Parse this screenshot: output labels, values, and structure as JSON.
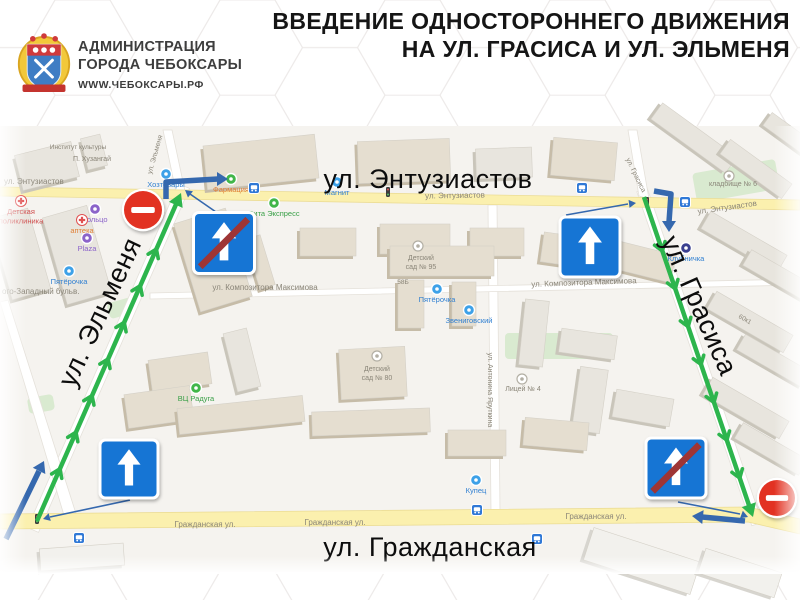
{
  "header": {
    "org_line1": "АДМИНИСТРАЦИЯ",
    "org_line2": "ГОРОДА ЧЕБОКСАРЫ",
    "org_url": "WWW.ЧЕБОКСАРЫ.РФ",
    "title_line1": "ВВЕДЕНИЕ ОДНОСТОРОННЕГО ДВИЖЕНИЯ",
    "title_line2": "НА УЛ. ГРАСИСА И УЛ. ЭЛЬМЕНЯ"
  },
  "colors": {
    "route_green": "#2db54d",
    "arrow_blue": "#3568ae",
    "sign_blue": "#1474d4",
    "sign_stripe_red": "#9e3434",
    "no_entry_red": "#e23223",
    "road_yellow": "#fbf0ae",
    "map_bg": "#f5f3ef"
  },
  "map": {
    "big_labels": [
      {
        "t": "ул. Энтузиастов",
        "x": 428,
        "y": 188,
        "r": 0
      },
      {
        "t": "ул. Эльменя",
        "x": 108,
        "y": 316,
        "r": -65
      },
      {
        "t": "ул. Грасиса",
        "x": 691,
        "y": 309,
        "r": 66
      },
      {
        "t": "ул. Гражданская",
        "x": 430,
        "y": 556,
        "r": 0
      }
    ],
    "small_labels": [
      {
        "t": "ул. Энтузиастов",
        "x": 4,
        "y": 184,
        "a": "start"
      },
      {
        "t": "ул. Энтузиастов",
        "x": 455,
        "y": 198,
        "r": -1
      },
      {
        "t": "ул. Энтузиастов",
        "x": 698,
        "y": 214,
        "r": -8,
        "a": "start"
      },
      {
        "t": "ул. Эльменя",
        "x": 157,
        "y": 155,
        "r": -74,
        "s": 7
      },
      {
        "t": "ул. Грасиса",
        "x": 634,
        "y": 176,
        "r": 64,
        "s": 7
      },
      {
        "t": "Гражданская ул.",
        "x": 205,
        "y": 527
      },
      {
        "t": "Гражданская ул.",
        "x": 335,
        "y": 525
      },
      {
        "t": "Гражданская ул.",
        "x": 596,
        "y": 519
      },
      {
        "t": "ул. Композитора Максимова",
        "x": 265,
        "y": 290
      },
      {
        "t": "ул. Композитора Максимова",
        "x": 584,
        "y": 285,
        "r": -2
      },
      {
        "t": "ого-Западный бульв.",
        "x": 2,
        "y": 294,
        "a": "start"
      },
      {
        "t": "ул. Антонина Яруткина",
        "x": 488,
        "y": 390,
        "r": 90,
        "s": 7
      },
      {
        "t": "П. Хузангай",
        "x": 92,
        "y": 161,
        "s": 7
      },
      {
        "t": "Институт культуры",
        "x": 78,
        "y": 149,
        "s": 6.5
      },
      {
        "t": "кладбище № 6",
        "x": 733,
        "y": 186,
        "s": 7
      },
      {
        "t": "Детский\nсад № 95",
        "x": 421,
        "y": 260,
        "s": 7
      },
      {
        "t": "Детский\nсад № 80",
        "x": 377,
        "y": 371,
        "s": 7
      },
      {
        "t": "Лицей № 4",
        "x": 523,
        "y": 391,
        "s": 7
      },
      {
        "t": "58Б",
        "x": 403,
        "y": 284,
        "s": 6.5
      },
      {
        "t": "60к1",
        "x": 744,
        "y": 321,
        "s": 6.5,
        "r": 30
      }
    ],
    "pois": [
      {
        "x": 166,
        "y": 174,
        "c": "#3da1e8",
        "t": "Хозтовары",
        "lc": "#2f7fd1"
      },
      {
        "x": 231,
        "y": 179,
        "c": "#41b649",
        "t": "Фармация",
        "lc": "#e07f35"
      },
      {
        "x": 337,
        "y": 182,
        "c": "#3da1e8",
        "t": "Магнит",
        "lc": "#2f7fd1"
      },
      {
        "x": 274,
        "y": 203,
        "c": "#41b649",
        "t": "Вита Экспресс",
        "lc": "#3aa048"
      },
      {
        "x": 69,
        "y": 271,
        "c": "#3da1e8",
        "t": "Пятёрочка",
        "lc": "#2f7fd1"
      },
      {
        "x": 95,
        "y": 209,
        "c": "#8b63c9",
        "t": "Кольцо",
        "lc": "#8b63c9"
      },
      {
        "x": 87,
        "y": 238,
        "c": "#8b63c9",
        "t": "Plaza",
        "lc": "#8b63c9"
      },
      {
        "x": 21,
        "y": 201,
        "c": "cross",
        "t": "Детская\nполиклиника",
        "lc": "#d05050"
      },
      {
        "x": 82,
        "y": 220,
        "c": "cross",
        "t": "аптека",
        "lc": "#e07f35"
      },
      {
        "x": 437,
        "y": 289,
        "c": "#3da1e8",
        "t": "Пятёрочка",
        "lc": "#2f7fd1"
      },
      {
        "x": 469,
        "y": 310,
        "c": "#3da1e8",
        "t": "Звениговский",
        "lc": "#2f7fd1"
      },
      {
        "x": 581,
        "y": 235,
        "c": "#3da1e8",
        "t": "Пятёрочка",
        "lc": "#2f7fd1"
      },
      {
        "x": 686,
        "y": 248,
        "c": "#3a3f8f",
        "t": "Клубничка",
        "lc": "#2f7fd1"
      },
      {
        "x": 476,
        "y": 480,
        "c": "#3da1e8",
        "t": "Купец",
        "lc": "#2f7fd1"
      },
      {
        "x": 196,
        "y": 388,
        "c": "#41b649",
        "t": "ВЦ Радуга",
        "lc": "#3aa048"
      },
      {
        "x": 418,
        "y": 246,
        "c": "gray",
        "t": "",
        "lc": ""
      },
      {
        "x": 377,
        "y": 356,
        "c": "gray",
        "t": "",
        "lc": ""
      },
      {
        "x": 522,
        "y": 379,
        "c": "gray",
        "t": "",
        "lc": ""
      },
      {
        "x": 729,
        "y": 176,
        "c": "gray",
        "t": "",
        "lc": ""
      }
    ],
    "bus_stops": [
      {
        "x": 254,
        "y": 188
      },
      {
        "x": 582,
        "y": 188
      },
      {
        "x": 685,
        "y": 202
      },
      {
        "x": 79,
        "y": 538
      },
      {
        "x": 477,
        "y": 510
      },
      {
        "x": 537,
        "y": 539
      }
    ],
    "traffic_lights": [
      {
        "x": 37,
        "y": 519
      },
      {
        "x": 388,
        "y": 192
      },
      {
        "x": 647,
        "y": 202
      }
    ],
    "routes": [
      {
        "name": "elmenya-northbound",
        "a": [
          37,
          521
        ],
        "b": [
          181,
          193
        ]
      },
      {
        "name": "grasisa-southbound",
        "a": [
          644,
          197
        ],
        "b": [
          753,
          517
        ]
      }
    ],
    "thick_arrows": [
      {
        "name": "exit-elmenya-turn-right",
        "pts": [
          [
            166,
            199
          ],
          [
            166,
            182
          ],
          [
            218,
            179
          ]
        ],
        "tip": [
          228,
          179
        ]
      },
      {
        "name": "enter-grasisa-turn-left",
        "pts": [
          [
            654,
            191
          ],
          [
            671,
            194
          ],
          [
            669,
            222
          ]
        ],
        "tip": [
          669,
          232
        ]
      },
      {
        "name": "enter-elmenya-from-grazhdanskaya",
        "pts": [
          [
            6,
            539
          ],
          [
            39,
            471
          ]
        ],
        "tip": [
          44,
          461
        ]
      },
      {
        "name": "exit-grasisa-turn-right",
        "pts": [
          [
            745,
            521
          ],
          [
            702,
            517
          ]
        ],
        "tip": [
          692,
          516
        ]
      }
    ],
    "thin_arrows": [
      {
        "pts": [
          [
            216,
            212
          ],
          [
            190,
            194
          ]
        ],
        "tip": [
          185,
          190
        ]
      },
      {
        "pts": [
          [
            566,
            215
          ],
          [
            628,
            204
          ]
        ],
        "tip": [
          636,
          203
        ]
      },
      {
        "pts": [
          [
            130,
            500
          ],
          [
            50,
            517
          ]
        ],
        "tip": [
          43,
          519
        ]
      },
      {
        "pts": [
          [
            678,
            502
          ],
          [
            740,
            514
          ]
        ],
        "tip": [
          748,
          517
        ]
      }
    ],
    "signs": [
      {
        "k": "no-entry",
        "x": 143,
        "y": 210,
        "r": 19
      },
      {
        "k": "ow-end",
        "x": 224,
        "y": 243,
        "s": 58
      },
      {
        "k": "ow",
        "x": 590,
        "y": 247,
        "s": 57
      },
      {
        "k": "ow",
        "x": 129,
        "y": 469,
        "s": 55
      },
      {
        "k": "ow-end",
        "x": 676,
        "y": 468,
        "s": 57
      },
      {
        "k": "no-entry",
        "x": 777,
        "y": 498,
        "r": 18
      }
    ],
    "green_areas": [
      [
        505,
        333,
        108,
        26,
        0
      ],
      [
        694,
        166,
        84,
        30,
        -10
      ],
      [
        28,
        396,
        26,
        16,
        -10
      ],
      [
        108,
        300,
        26,
        16,
        -16
      ]
    ],
    "buildings": [
      [
        18,
        148,
        58,
        36,
        -14,
        0
      ],
      [
        84,
        136,
        20,
        32,
        -14,
        0
      ],
      [
        205,
        140,
        112,
        44,
        -6,
        1
      ],
      [
        358,
        140,
        92,
        42,
        -2,
        1
      ],
      [
        476,
        148,
        56,
        30,
        -2,
        0
      ],
      [
        552,
        140,
        64,
        38,
        5,
        1
      ],
      [
        648,
        128,
        92,
        20,
        36,
        0
      ],
      [
        718,
        160,
        76,
        18,
        36,
        0
      ],
      [
        762,
        128,
        58,
        16,
        36,
        0
      ],
      [
        0,
        212,
        40,
        84,
        -16,
        0
      ],
      [
        54,
        210,
        46,
        90,
        -16,
        0
      ],
      [
        186,
        214,
        54,
        92,
        -17,
        1
      ],
      [
        252,
        236,
        16,
        52,
        -17,
        1
      ],
      [
        300,
        228,
        56,
        28,
        0,
        1
      ],
      [
        380,
        224,
        70,
        30,
        0,
        1
      ],
      [
        470,
        228,
        54,
        28,
        0,
        1
      ],
      [
        542,
        236,
        60,
        30,
        8,
        1
      ],
      [
        616,
        248,
        58,
        28,
        14,
        1
      ],
      [
        700,
        232,
        88,
        20,
        30,
        0
      ],
      [
        742,
        268,
        78,
        18,
        30,
        0
      ],
      [
        706,
        312,
        88,
        20,
        30,
        0
      ],
      [
        736,
        352,
        76,
        18,
        30,
        0
      ],
      [
        702,
        398,
        88,
        20,
        30,
        0
      ],
      [
        734,
        440,
        74,
        18,
        30,
        0
      ],
      [
        150,
        356,
        60,
        32,
        -8,
        1
      ],
      [
        126,
        390,
        66,
        34,
        -8,
        1
      ],
      [
        230,
        330,
        24,
        60,
        -14,
        0
      ],
      [
        390,
        246,
        104,
        30,
        0,
        1
      ],
      [
        398,
        280,
        26,
        48,
        0,
        1
      ],
      [
        452,
        282,
        24,
        44,
        0,
        1
      ],
      [
        340,
        348,
        66,
        50,
        -3,
        1
      ],
      [
        522,
        300,
        24,
        66,
        6,
        0
      ],
      [
        560,
        332,
        56,
        24,
        8,
        0
      ],
      [
        576,
        368,
        28,
        64,
        8,
        0
      ],
      [
        178,
        402,
        126,
        26,
        -6,
        1
      ],
      [
        312,
        410,
        118,
        24,
        -2,
        1
      ],
      [
        448,
        430,
        58,
        26,
        0,
        1
      ],
      [
        524,
        420,
        64,
        28,
        5,
        1
      ],
      [
        614,
        394,
        58,
        28,
        10,
        0
      ],
      [
        40,
        546,
        84,
        22,
        -4,
        2
      ],
      [
        586,
        544,
        112,
        34,
        18,
        2
      ],
      [
        700,
        560,
        80,
        26,
        18,
        2
      ]
    ]
  }
}
